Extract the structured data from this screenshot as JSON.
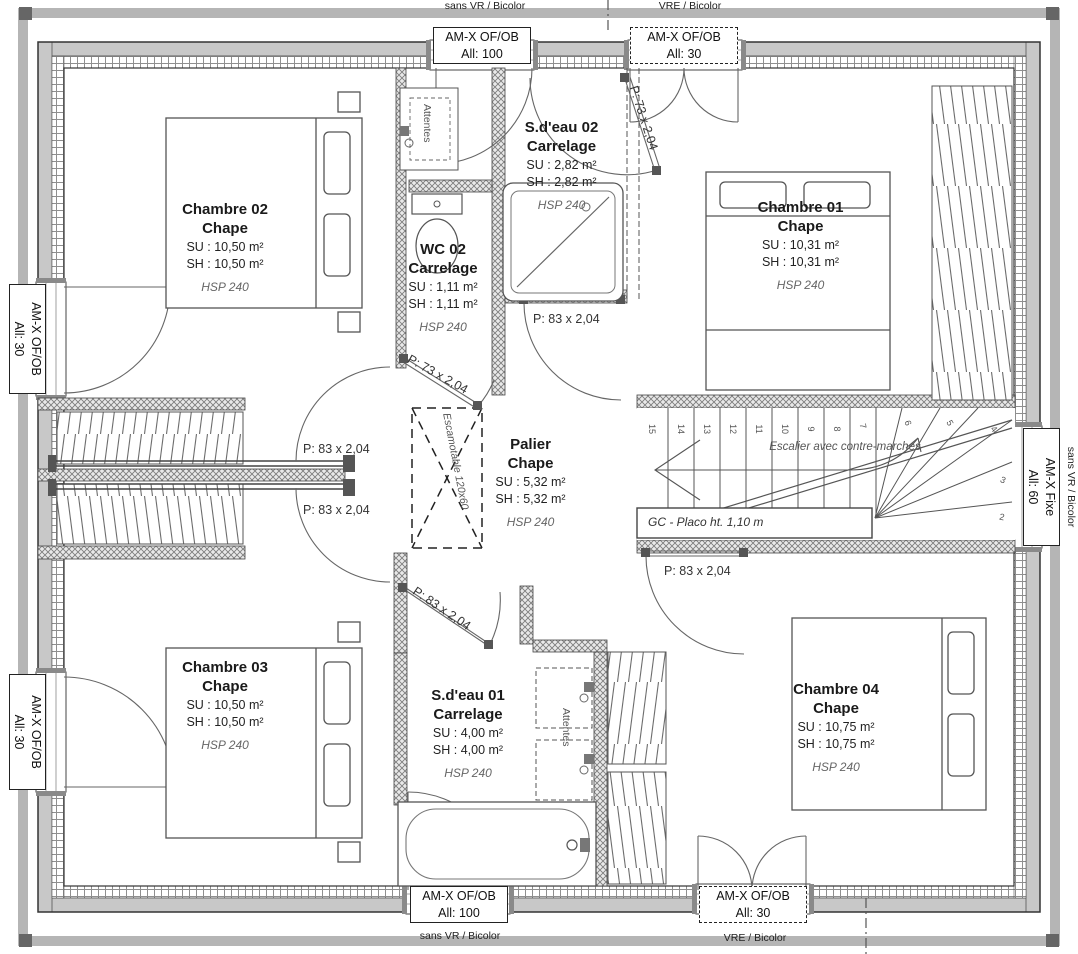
{
  "drawing": {
    "type": "floor-plan",
    "colors": {
      "line": "#3f3f3f",
      "wall_fill": "#c8c8c8",
      "hatch": "#8a8a8a",
      "background": "#ffffff"
    }
  },
  "rooms": {
    "chambre02": {
      "name": "Chambre 02",
      "finish": "Chape",
      "su": "SU : 10,50 m²",
      "sh": "SH : 10,50 m²",
      "hsp": "HSP 240"
    },
    "sdeau02": {
      "name": "S.d'eau 02",
      "finish": "Carrelage",
      "su": "SU : 2,82 m²",
      "sh": "SH : 2,82 m²",
      "hsp": "HSP 240"
    },
    "wc02": {
      "name": "WC 02",
      "finish": "Carrelage",
      "su": "SU : 1,11 m²",
      "sh": "SH : 1,11 m²",
      "hsp": "HSP 240"
    },
    "chambre01": {
      "name": "Chambre 01",
      "finish": "Chape",
      "su": "SU : 10,31 m²",
      "sh": "SH : 10,31 m²",
      "hsp": "HSP 240"
    },
    "palier": {
      "name": "Palier",
      "finish": "Chape",
      "su": "SU : 5,32 m²",
      "sh": "SH : 5,32 m²",
      "hsp": "HSP 240"
    },
    "chambre03": {
      "name": "Chambre 03",
      "finish": "Chape",
      "su": "SU : 10,50 m²",
      "sh": "SH : 10,50 m²",
      "hsp": "HSP 240"
    },
    "sdeau01": {
      "name": "S.d'eau 01",
      "finish": "Carrelage",
      "su": "SU : 4,00 m²",
      "sh": "SH : 4,00 m²",
      "hsp": "HSP 240"
    },
    "chambre04": {
      "name": "Chambre 04",
      "finish": "Chape",
      "su": "SU : 10,75 m²",
      "sh": "SH : 10,75 m²",
      "hsp": "HSP 240"
    }
  },
  "doors": {
    "d73_top": "P: 73 x 2,04",
    "d73_wc": "P: 73 x 2,04",
    "d83_sdeau02": "P: 83 x 2,04",
    "d83_ch02": "P: 83 x 2,04",
    "d83_ch03": "P: 83 x 2,04",
    "d83_ch04": "P: 83 x 2,04",
    "d83_sdeau01": "P: 83 x 2,04"
  },
  "windows": {
    "top1": {
      "line1": "AM-X OF/OB",
      "line2": "All: 100",
      "caption": "sans VR / Bicolor"
    },
    "top2": {
      "line1": "AM-X OF/OB",
      "line2": "All: 30",
      "caption": "VRE / Bicolor"
    },
    "left1": {
      "line1": "AM-X OF/OB",
      "line2": "All: 30"
    },
    "left2": {
      "line1": "AM-X OF/OB",
      "line2": "All: 30"
    },
    "right1": {
      "line1": "AM-X Fixe",
      "line2": "All: 60",
      "caption": "sans VR / Bicolor"
    },
    "bottom1": {
      "line1": "AM-X OF/OB",
      "line2": "All: 100",
      "caption": "sans VR / Bicolor"
    },
    "bottom2": {
      "line1": "AM-X OF/OB",
      "line2": "All: 30",
      "caption": "VRE / Bicolor"
    }
  },
  "stairs": {
    "label": "Escalier avec contre-marches",
    "guard": "GC - Placo ht. 1,10 m",
    "step_numbers": [
      "15",
      "14",
      "13",
      "12",
      "11",
      "10",
      "9",
      "8",
      "7",
      "6",
      "5",
      "4",
      "3",
      "2"
    ]
  },
  "annotations": {
    "attentes_top": "Attentes",
    "attentes_bottom": "Attentes",
    "trap_hatch": "Escamotable 120x60"
  }
}
